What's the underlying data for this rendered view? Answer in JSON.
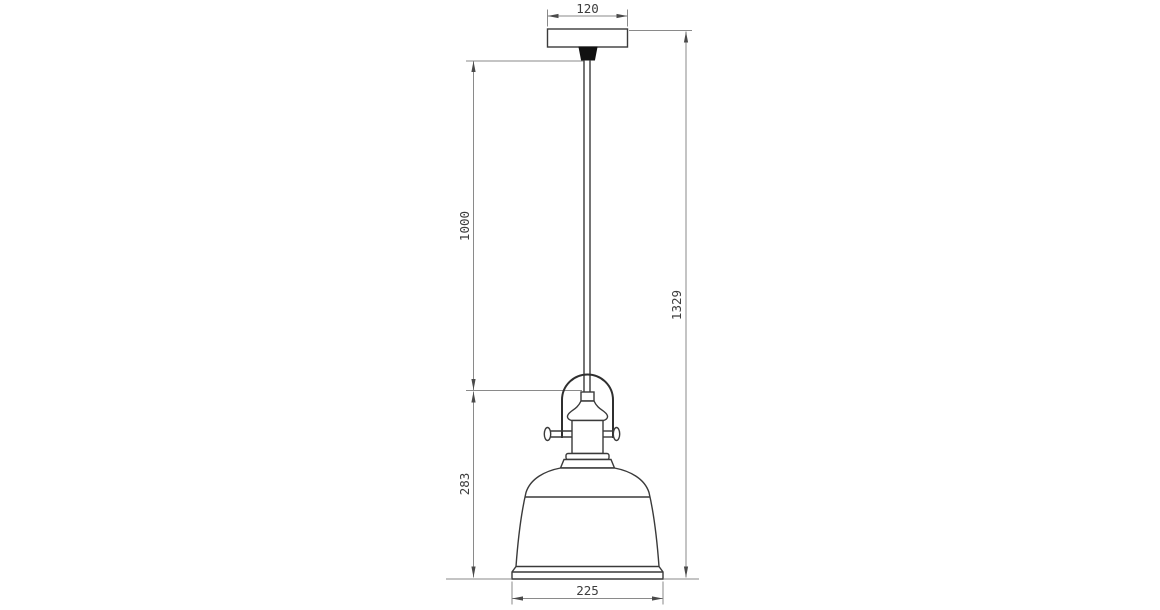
{
  "drawing": {
    "background_color": "#ffffff",
    "object_line_color": "#3a3a3a",
    "dimension_line_color": "#8a8a8a",
    "text_color": "#3d3d3d",
    "strain_relief_color": "#111111",
    "dimensions": {
      "canopy_width": "120",
      "cord_length": "1000",
      "lamp_height": "283",
      "total_height": "1329",
      "shade_diameter": "225"
    }
  }
}
